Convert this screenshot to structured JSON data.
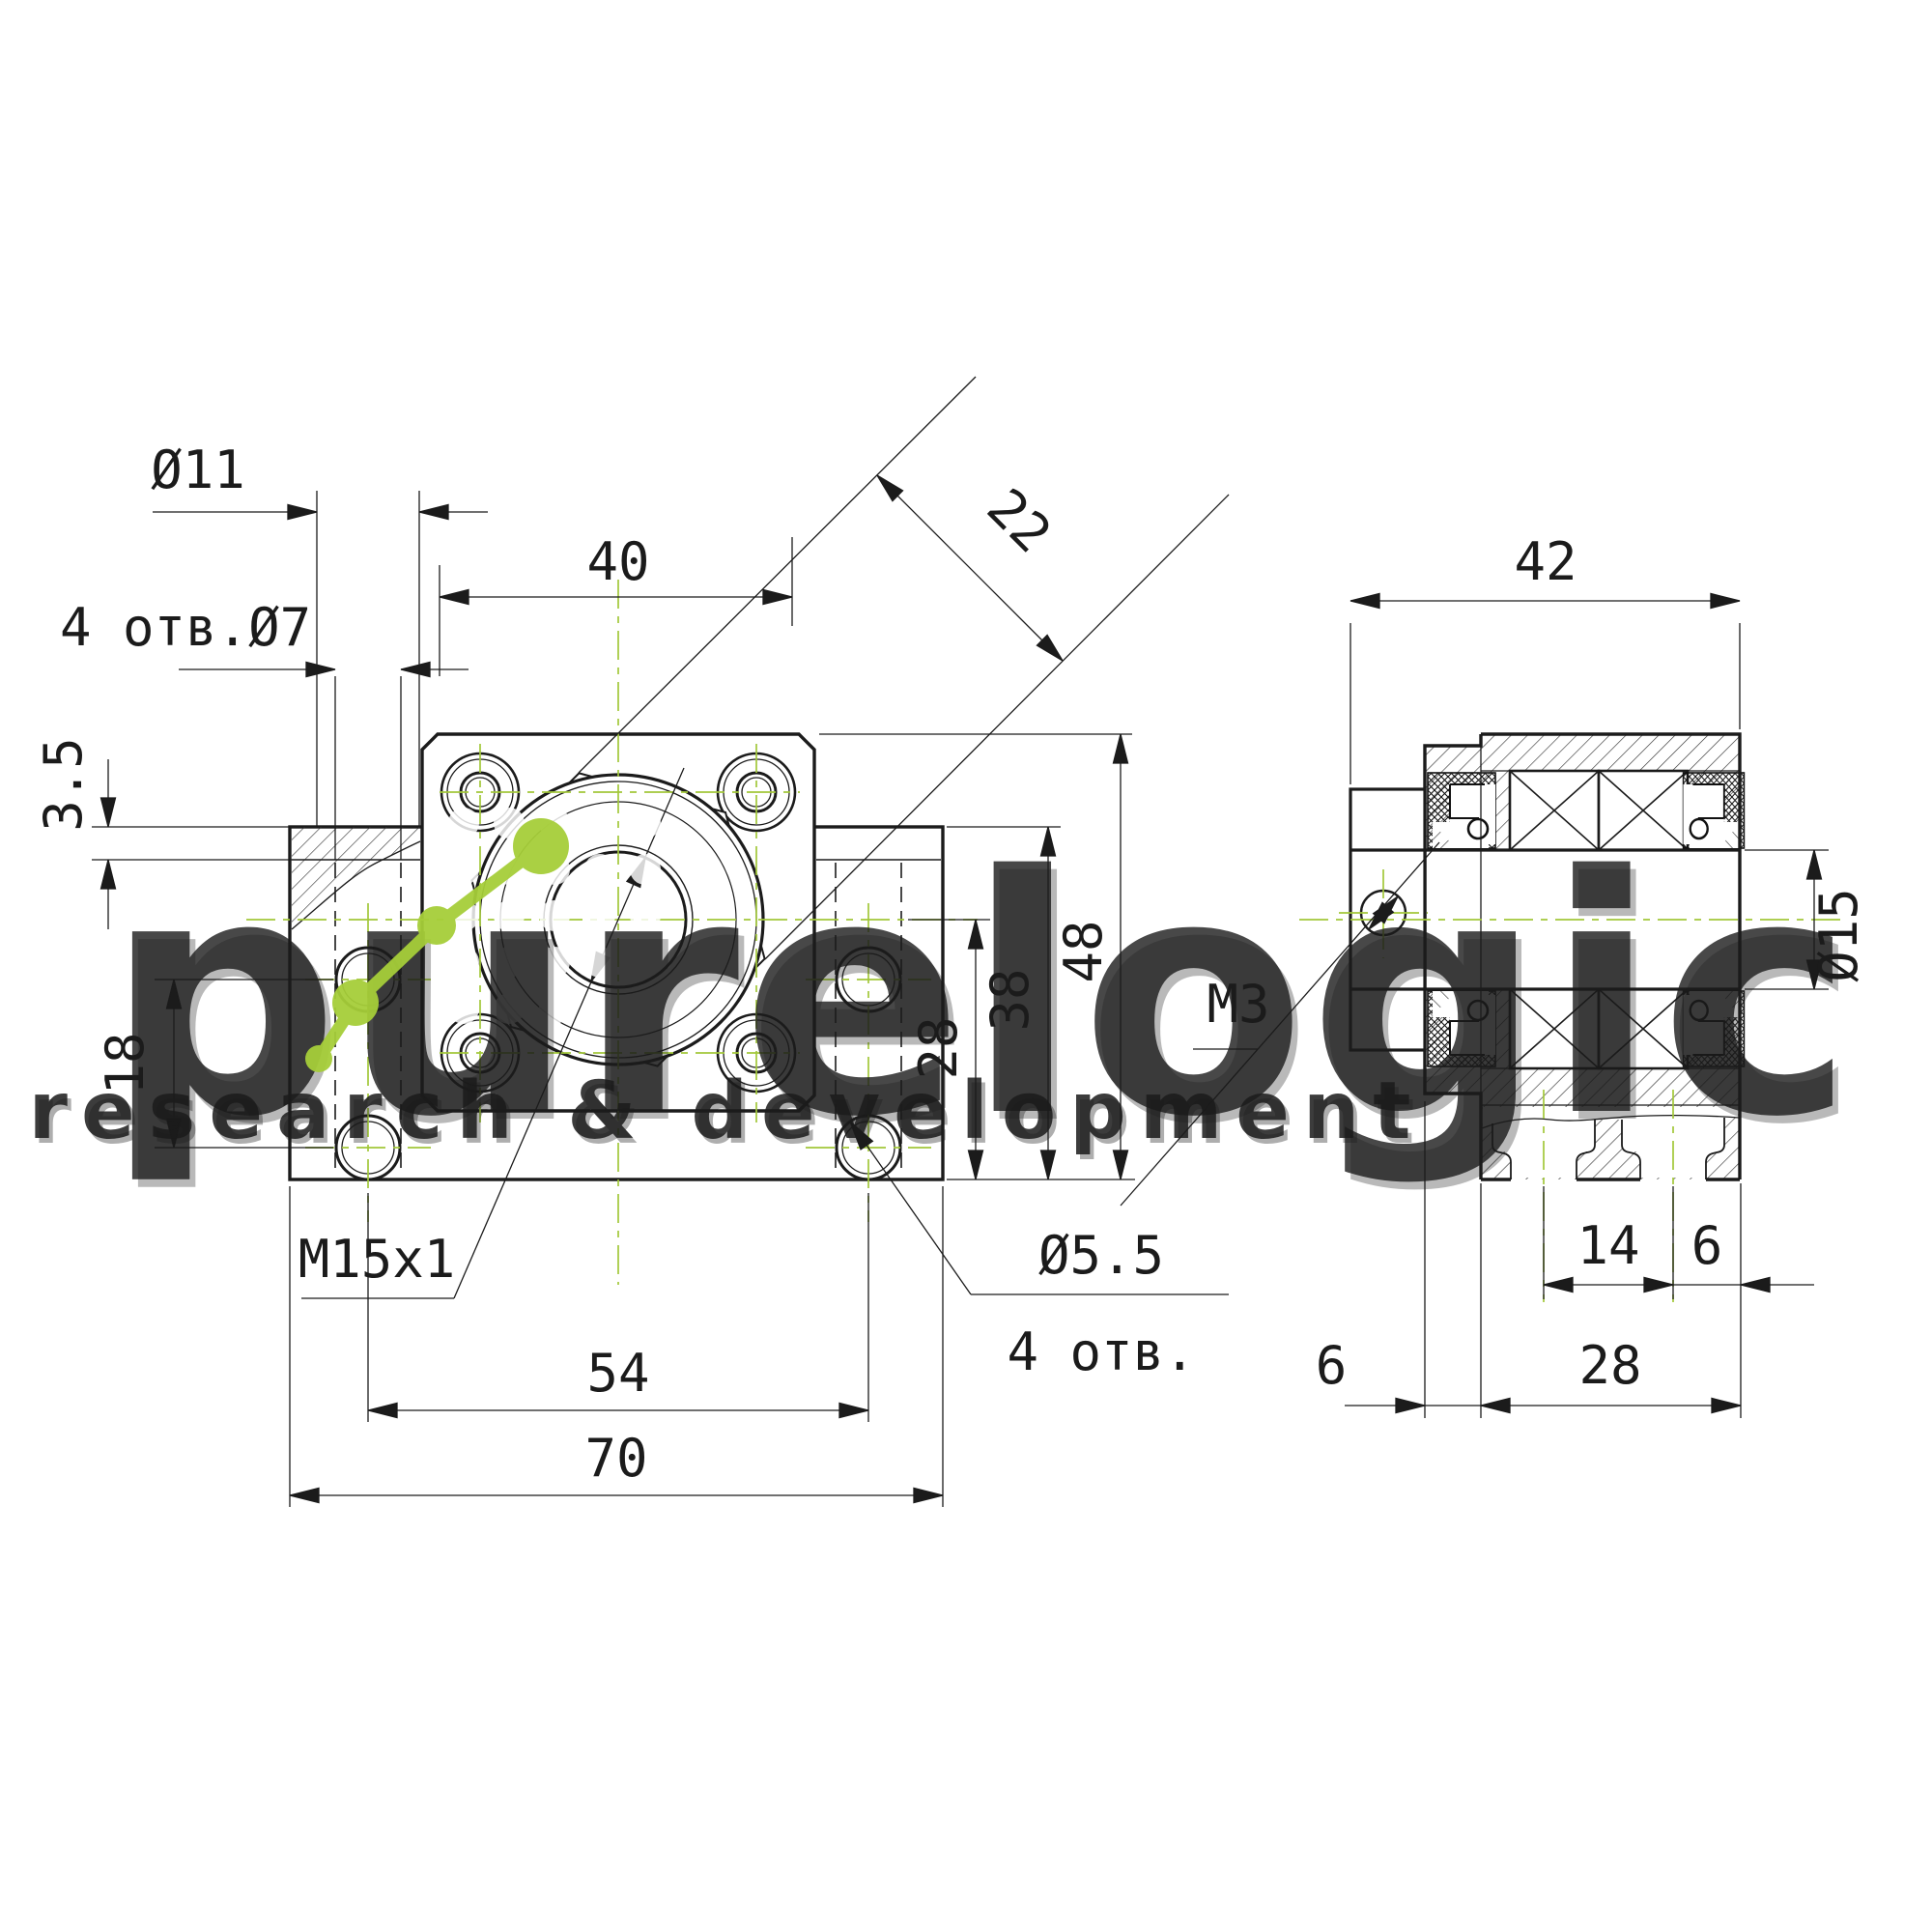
{
  "front": {
    "d11": "Ø11",
    "holes7": "4 отв.Ø7",
    "w40": "40",
    "d22": "22",
    "t35": "3.5",
    "t18": "18",
    "thread": "M15x1",
    "w54": "54",
    "w70": "70",
    "v28": "28",
    "v38": "38",
    "v48": "48",
    "d55": "Ø5.5",
    "holes4": "4 отв."
  },
  "side": {
    "m3": "M3",
    "w42": "42",
    "d15": "Ø15",
    "b14": "14",
    "b6a": "6",
    "b6b": "6",
    "b28": "28"
  },
  "wm": {
    "name": "purelogic",
    "tagline": "research & development"
  },
  "colors": {
    "line": "#1b1b1b",
    "centerline": "#a2c83a",
    "logo_green": "#a6ce39",
    "watermark": "#ffffff"
  }
}
